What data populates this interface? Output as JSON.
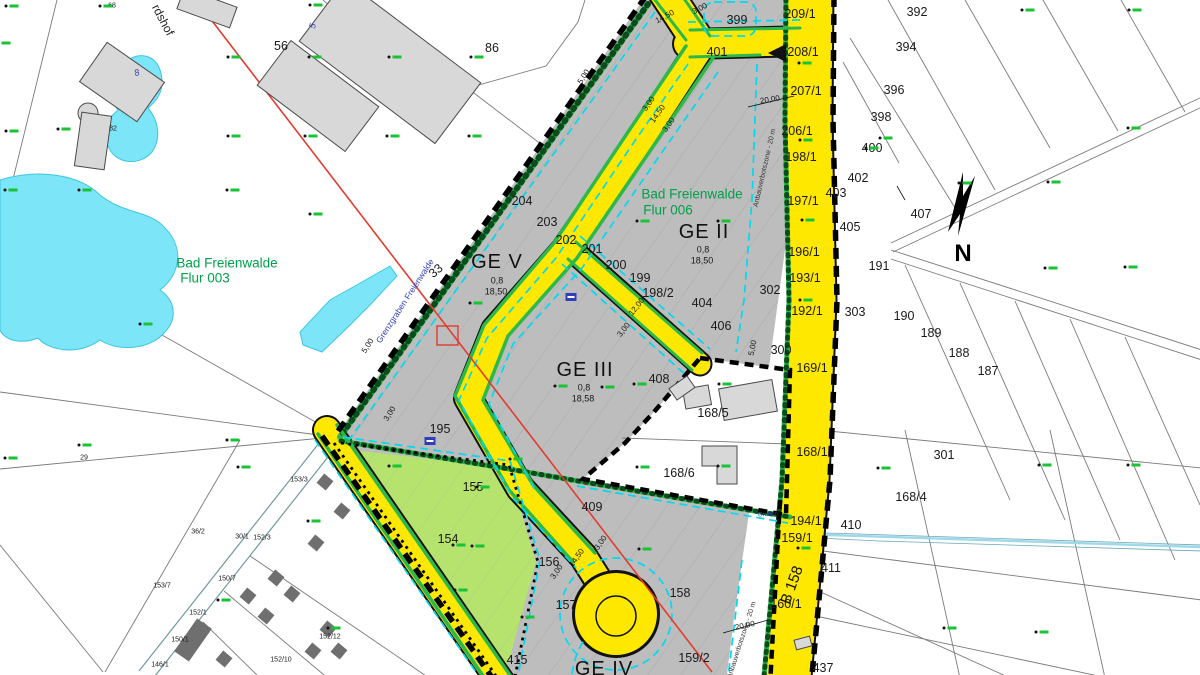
{
  "map": {
    "north_letter": "N",
    "zones": [
      {
        "name": "GE V",
        "grz": "0,8",
        "max_height": "18,50"
      },
      {
        "name": "GE II",
        "grz": "0,8",
        "max_height": "18,50"
      },
      {
        "name": "GE III",
        "grz": "0,8",
        "max_height": "18,58"
      },
      {
        "name": "GE IV"
      }
    ],
    "districts": [
      "Bad Freienwalde Flur 003",
      "Bad Freienwalde Flur 006"
    ],
    "road_name": "B 158",
    "stream_name": "Grenzgraben Freienwalde",
    "restriction": "Anbauverbotszone - 20 m",
    "colors": {
      "road_yellow": "#ffe800",
      "plan_gray": "#bdbdbd",
      "green_strip": "#2db84b",
      "light_green_area": "#b5e36e",
      "water_cyan": "#7ce5f8",
      "plan_line_cyan": "#00d9ef",
      "marker_green": "#19c335",
      "district_green": "#00a14b",
      "red_line": "#e23b30"
    }
  },
  "labels": [
    {
      "t": "399",
      "x": 737,
      "y": 20,
      "c": "p"
    },
    {
      "t": "401",
      "x": 717,
      "y": 52,
      "c": "p"
    },
    {
      "t": "209/1",
      "x": 800,
      "y": 14,
      "c": "p"
    },
    {
      "t": "208/1",
      "x": 803,
      "y": 52,
      "c": "p"
    },
    {
      "t": "207/1",
      "x": 806,
      "y": 91,
      "c": "p"
    },
    {
      "t": "206/1",
      "x": 797,
      "y": 131,
      "c": "p"
    },
    {
      "t": "198/1",
      "x": 801,
      "y": 157,
      "c": "p"
    },
    {
      "t": "197/1",
      "x": 803,
      "y": 201,
      "c": "p"
    },
    {
      "t": "196/1",
      "x": 804,
      "y": 252,
      "c": "p"
    },
    {
      "t": "193/1",
      "x": 805,
      "y": 278,
      "c": "p"
    },
    {
      "t": "192/1",
      "x": 807,
      "y": 311,
      "c": "p"
    },
    {
      "t": "392",
      "x": 917,
      "y": 12,
      "c": "p"
    },
    {
      "t": "394",
      "x": 906,
      "y": 47,
      "c": "p"
    },
    {
      "t": "396",
      "x": 894,
      "y": 90,
      "c": "p"
    },
    {
      "t": "398",
      "x": 881,
      "y": 117,
      "c": "p"
    },
    {
      "t": "400",
      "x": 872,
      "y": 148,
      "c": "p"
    },
    {
      "t": "402",
      "x": 858,
      "y": 178,
      "c": "p"
    },
    {
      "t": "403",
      "x": 836,
      "y": 193,
      "c": "p"
    },
    {
      "t": "405",
      "x": 850,
      "y": 227,
      "c": "p"
    },
    {
      "t": "407",
      "x": 921,
      "y": 214,
      "c": "p"
    },
    {
      "t": "191",
      "x": 879,
      "y": 266,
      "c": "p"
    },
    {
      "t": "190",
      "x": 904,
      "y": 316,
      "c": "p"
    },
    {
      "t": "189",
      "x": 931,
      "y": 333,
      "c": "p"
    },
    {
      "t": "188",
      "x": 959,
      "y": 353,
      "c": "p"
    },
    {
      "t": "187",
      "x": 988,
      "y": 371,
      "c": "p"
    },
    {
      "t": "303",
      "x": 855,
      "y": 312,
      "c": "p"
    },
    {
      "t": "302",
      "x": 770,
      "y": 290,
      "c": "p"
    },
    {
      "t": "300",
      "x": 781,
      "y": 350,
      "c": "p"
    },
    {
      "t": "301",
      "x": 944,
      "y": 455,
      "c": "p"
    },
    {
      "t": "169/1",
      "x": 812,
      "y": 368,
      "c": "p"
    },
    {
      "t": "168/1",
      "x": 812,
      "y": 452,
      "c": "p"
    },
    {
      "t": "168/4",
      "x": 911,
      "y": 497,
      "c": "p"
    },
    {
      "t": "168/5",
      "x": 713,
      "y": 413,
      "c": "p"
    },
    {
      "t": "168/6",
      "x": 679,
      "y": 473,
      "c": "p"
    },
    {
      "t": "204",
      "x": 522,
      "y": 201,
      "c": "p"
    },
    {
      "t": "203",
      "x": 547,
      "y": 222,
      "c": "p"
    },
    {
      "t": "202",
      "x": 566,
      "y": 240,
      "c": "p"
    },
    {
      "t": "201",
      "x": 592,
      "y": 249,
      "c": "p"
    },
    {
      "t": "200",
      "x": 616,
      "y": 265,
      "c": "p"
    },
    {
      "t": "199",
      "x": 640,
      "y": 278,
      "c": "p"
    },
    {
      "t": "198/2",
      "x": 658,
      "y": 293,
      "c": "p"
    },
    {
      "t": "404",
      "x": 702,
      "y": 303,
      "c": "p"
    },
    {
      "t": "406",
      "x": 721,
      "y": 326,
      "c": "p"
    },
    {
      "t": "408",
      "x": 659,
      "y": 379,
      "c": "p"
    },
    {
      "t": "194/1",
      "x": 806,
      "y": 521,
      "c": "p"
    },
    {
      "t": "410",
      "x": 851,
      "y": 525,
      "c": "p"
    },
    {
      "t": "159/1",
      "x": 797,
      "y": 538,
      "c": "p"
    },
    {
      "t": "411",
      "x": 831,
      "y": 568,
      "c": "p"
    },
    {
      "t": "160/1",
      "x": 786,
      "y": 604,
      "c": "p"
    },
    {
      "t": "437",
      "x": 823,
      "y": 668,
      "c": "p"
    },
    {
      "t": "415",
      "x": 517,
      "y": 660,
      "c": "p"
    },
    {
      "t": "156",
      "x": 549,
      "y": 562,
      "c": "p"
    },
    {
      "t": "157",
      "x": 566,
      "y": 605,
      "c": "p"
    },
    {
      "t": "158",
      "x": 680,
      "y": 593,
      "c": "p"
    },
    {
      "t": "159/2",
      "x": 694,
      "y": 658,
      "c": "p"
    },
    {
      "t": "155",
      "x": 473,
      "y": 487,
      "c": "p"
    },
    {
      "t": "154",
      "x": 448,
      "y": 539,
      "c": "p"
    },
    {
      "t": "195",
      "x": 440,
      "y": 429,
      "c": "p"
    },
    {
      "t": "409",
      "x": 592,
      "y": 507,
      "c": "p"
    },
    {
      "t": "56",
      "x": 281,
      "y": 46,
      "c": "p"
    },
    {
      "t": "86",
      "x": 492,
      "y": 48,
      "c": "p"
    },
    {
      "t": "33",
      "x": 436,
      "y": 271,
      "c": "p",
      "r": -40
    },
    {
      "t": "68",
      "x": 112,
      "y": 6,
      "c": "ps"
    },
    {
      "t": "82",
      "x": 113,
      "y": 129,
      "c": "ps"
    },
    {
      "t": "29",
      "x": 84,
      "y": 458,
      "c": "ps"
    },
    {
      "t": "153/7",
      "x": 162,
      "y": 586,
      "c": "ps"
    },
    {
      "t": "153/3",
      "x": 299,
      "y": 480,
      "c": "ps"
    },
    {
      "t": "36/2",
      "x": 198,
      "y": 532,
      "c": "ps"
    },
    {
      "t": "30/1",
      "x": 242,
      "y": 537,
      "c": "ps"
    },
    {
      "t": "152/3",
      "x": 262,
      "y": 538,
      "c": "ps"
    },
    {
      "t": "150/7",
      "x": 227,
      "y": 579,
      "c": "ps"
    },
    {
      "t": "152/1",
      "x": 198,
      "y": 613,
      "c": "ps"
    },
    {
      "t": "150/1",
      "x": 180,
      "y": 640,
      "c": "ps"
    },
    {
      "t": "146/1",
      "x": 160,
      "y": 665,
      "c": "ps"
    },
    {
      "t": "152/10",
      "x": 281,
      "y": 660,
      "c": "ps"
    },
    {
      "t": "152/12",
      "x": 330,
      "y": 637,
      "c": "ps"
    },
    {
      "t": "GE V",
      "x": 497,
      "y": 262,
      "c": "zone"
    },
    {
      "t": "0,8",
      "x": 497,
      "y": 281,
      "c": "zsub"
    },
    {
      "t": "18,50",
      "x": 496,
      "y": 292,
      "c": "zsub"
    },
    {
      "t": "GE II",
      "x": 704,
      "y": 232,
      "c": "zone"
    },
    {
      "t": "0,8",
      "x": 703,
      "y": 250,
      "c": "zsub"
    },
    {
      "t": "18,50",
      "x": 702,
      "y": 261,
      "c": "zsub"
    },
    {
      "t": "GE III",
      "x": 585,
      "y": 370,
      "c": "zone"
    },
    {
      "t": "0,8",
      "x": 584,
      "y": 388,
      "c": "zsub"
    },
    {
      "t": "18,58",
      "x": 583,
      "y": 399,
      "c": "zsub"
    },
    {
      "t": "GE IV",
      "x": 604,
      "y": 669,
      "c": "zone"
    },
    {
      "t": "Bad Freienwalde",
      "x": 692,
      "y": 194,
      "c": "green"
    },
    {
      "t": "Flur 006",
      "x": 668,
      "y": 210,
      "c": "green"
    },
    {
      "t": "Bad Freienwalde",
      "x": 227,
      "y": 263,
      "c": "green"
    },
    {
      "t": "Flur 003",
      "x": 205,
      "y": 278,
      "c": "green"
    },
    {
      "t": "Grenzgraben Freienwalde",
      "x": 405,
      "y": 301,
      "c": "blue",
      "r": -57
    },
    {
      "t": "B 158",
      "x": 792,
      "y": 585,
      "c": "roadname",
      "r": -70
    },
    {
      "t": "rdshof",
      "x": 163,
      "y": 20,
      "c": "street",
      "r": 62
    },
    {
      "t": "Anbauverbotszone - 20 m",
      "x": 765,
      "y": 168,
      "c": "anbau",
      "r": -77
    },
    {
      "t": "Anbauverbotszone - 20 m",
      "x": 742,
      "y": 640,
      "c": "anbau",
      "r": -72
    },
    {
      "t": "Graben",
      "x": 768,
      "y": 515,
      "c": "tinyblue",
      "r": -3
    },
    {
      "t": "5",
      "x": 313,
      "y": 26,
      "c": "bluenum",
      "r": -75
    },
    {
      "t": "8",
      "x": 137,
      "y": 73,
      "c": "bluenum",
      "r": -20
    },
    {
      "t": "14,50",
      "x": 665,
      "y": 17,
      "c": "m",
      "r": -28
    },
    {
      "t": "3,00",
      "x": 700,
      "y": 9,
      "c": "m",
      "r": -28
    },
    {
      "t": "20,00",
      "x": 770,
      "y": 100,
      "c": "m",
      "r": -9
    },
    {
      "t": "5,00",
      "x": 584,
      "y": 77,
      "c": "m",
      "r": -58
    },
    {
      "t": "3,00",
      "x": 649,
      "y": 104,
      "c": "m",
      "r": -55
    },
    {
      "t": "14,50",
      "x": 658,
      "y": 114,
      "c": "m",
      "r": -55
    },
    {
      "t": "3,00",
      "x": 669,
      "y": 125,
      "c": "m",
      "r": -55
    },
    {
      "t": "12,00",
      "x": 637,
      "y": 307,
      "c": "m",
      "r": -52
    },
    {
      "t": "3,00",
      "x": 624,
      "y": 330,
      "c": "m",
      "r": -52
    },
    {
      "t": "5,00",
      "x": 753,
      "y": 348,
      "c": "m",
      "r": -78
    },
    {
      "t": "5,00",
      "x": 368,
      "y": 346,
      "c": "m",
      "r": -58
    },
    {
      "t": "3,00",
      "x": 390,
      "y": 414,
      "c": "m",
      "r": -58
    },
    {
      "t": "3,00",
      "x": 557,
      "y": 572,
      "c": "m",
      "r": -55
    },
    {
      "t": "14,50",
      "x": 577,
      "y": 558,
      "c": "m",
      "r": -55
    },
    {
      "t": "3,00",
      "x": 601,
      "y": 543,
      "c": "m",
      "r": -55
    },
    {
      "t": "20,00",
      "x": 745,
      "y": 626,
      "c": "m",
      "r": -12
    }
  ],
  "markers": [
    [
      14,
      6
    ],
    [
      108,
      6
    ],
    [
      318,
      5
    ],
    [
      6,
      43
    ],
    [
      66,
      129
    ],
    [
      14,
      131
    ],
    [
      236,
      57
    ],
    [
      317,
      57
    ],
    [
      397,
      57
    ],
    [
      479,
      57
    ],
    [
      236,
      136
    ],
    [
      313,
      136
    ],
    [
      395,
      136
    ],
    [
      477,
      136
    ],
    [
      13,
      190
    ],
    [
      87,
      190
    ],
    [
      235,
      190
    ],
    [
      318,
      214
    ],
    [
      148,
      324
    ],
    [
      87,
      445
    ],
    [
      13,
      458
    ],
    [
      235,
      440
    ],
    [
      246,
      467
    ],
    [
      316,
      521
    ],
    [
      226,
      600
    ],
    [
      336,
      628
    ],
    [
      463,
      590
    ],
    [
      518,
      459
    ],
    [
      485,
      487
    ],
    [
      461,
      545
    ],
    [
      645,
      221
    ],
    [
      726,
      221
    ],
    [
      478,
      303
    ],
    [
      563,
      386
    ],
    [
      610,
      387
    ],
    [
      642,
      384
    ],
    [
      727,
      384
    ],
    [
      645,
      467
    ],
    [
      726,
      466
    ],
    [
      967,
      183
    ],
    [
      1056,
      182
    ],
    [
      874,
      148
    ],
    [
      888,
      138
    ],
    [
      1136,
      128
    ],
    [
      1133,
      267
    ],
    [
      1053,
      268
    ],
    [
      886,
      468
    ],
    [
      1047,
      465
    ],
    [
      1136,
      465
    ],
    [
      952,
      628
    ],
    [
      1044,
      632
    ],
    [
      1137,
      10
    ],
    [
      1030,
      10
    ],
    [
      807,
      63
    ],
    [
      808,
      140
    ],
    [
      810,
      220
    ],
    [
      808,
      300
    ],
    [
      806,
      548
    ],
    [
      647,
      549
    ],
    [
      530,
      617
    ],
    [
      397,
      466
    ],
    [
      480,
      546
    ]
  ]
}
